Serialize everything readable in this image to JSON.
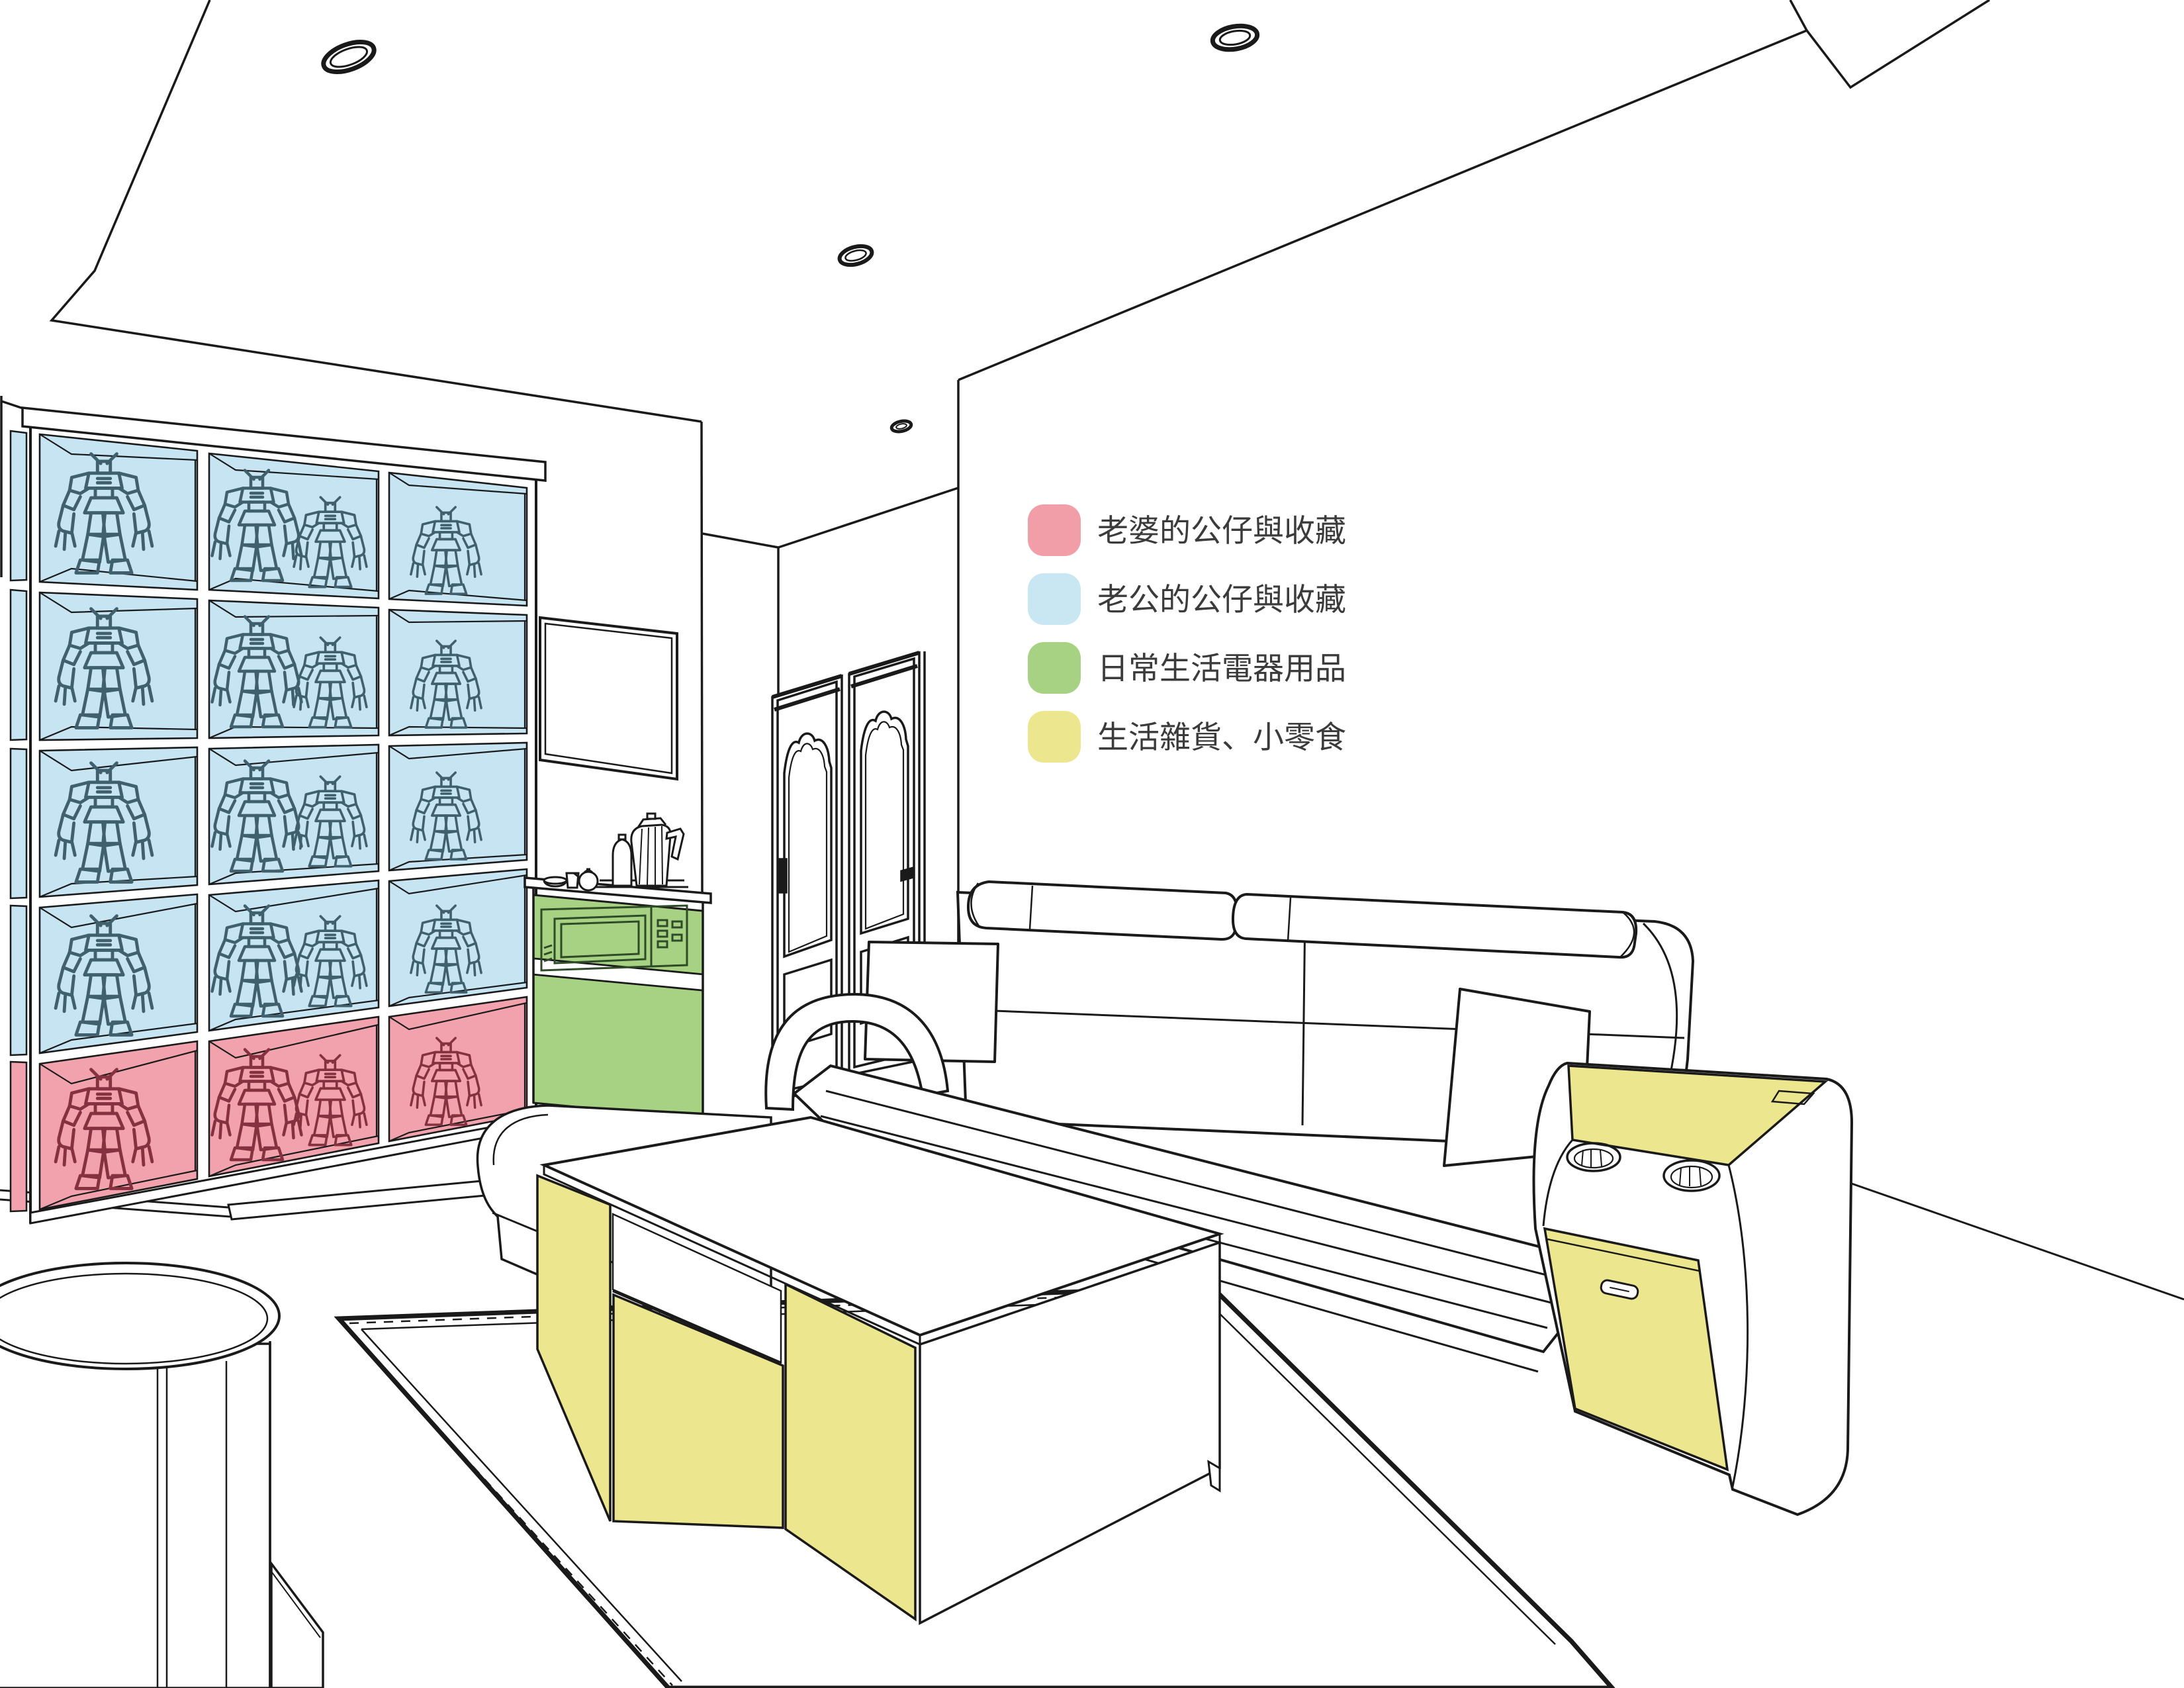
{
  "legend": {
    "items": [
      {
        "id": "wife-collection",
        "label": "老婆的公仔與收藏",
        "color": "#F29EA9"
      },
      {
        "id": "husband-collection",
        "label": "老公的公仔與收藏",
        "color": "#C9E6F3"
      },
      {
        "id": "daily-appliances",
        "label": "日常生活電器用品",
        "color": "#A7D284"
      },
      {
        "id": "sundries-snacks",
        "label": "生活雜貨、小零食",
        "color": "#ECE78E"
      }
    ]
  },
  "colors": {
    "zone_wife_pink": "#F2A2AD",
    "zone_husband_blue": "#C6E4F2",
    "zone_appliance_green": "#A7D284",
    "zone_sundries_yellow": "#ECE78E",
    "figure_blue": "#40606E",
    "figure_red": "#86313F",
    "microwave_green": "#2F4A26",
    "line": "#1A1A1A",
    "text": "#3B3B3B",
    "wall": "#FFFFFF"
  },
  "shelf": {
    "rows": 5,
    "columns": 3,
    "row_zone_by_index": [
      "husband",
      "husband",
      "husband",
      "husband",
      "wife"
    ],
    "cell_contents": "robot model figures"
  },
  "scene_objects": [
    "display-shelf-with-robot-figures",
    "wall-frame",
    "appliance-cabinet-with-microwave",
    "electric-kettle",
    "teapot",
    "cup",
    "bowl",
    "canister",
    "tray",
    "double-doors",
    "sofa-with-headrests-and-pillows",
    "chaise-seat",
    "side-table-with-cup-holders-and-drawer",
    "coffee-table-with-yellow-panels",
    "rug",
    "round-drum-table",
    "ceiling-downlights"
  ]
}
